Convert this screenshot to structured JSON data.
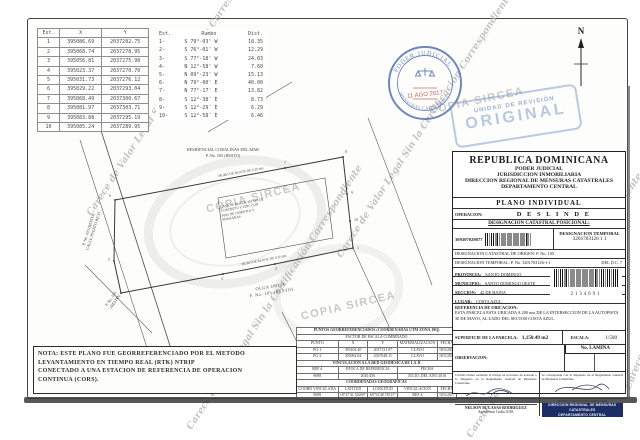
{
  "watermarks": {
    "copia": "COPIA SIRCEA",
    "legal": "Carece de Valor Legal Sin la Certificación Correspondiente"
  },
  "north": {
    "label": "N"
  },
  "stamps": {
    "circular": {
      "top": "PODER JUDICIAL",
      "bottom": "MENSURAS CATASTRALES",
      "date": "11 AGO 2017"
    },
    "revision": {
      "line1": "UNIDAD DE REVISIÓN",
      "line2": "ORIGINAL"
    }
  },
  "tables": {
    "coords": {
      "headers": {
        "est": "Est.",
        "x": "X",
        "y": "Y"
      },
      "rows": [
        {
          "est": "1",
          "x": "395086.69",
          "y": "2037282.75"
        },
        {
          "est": "2",
          "x": "395068.74",
          "y": "2037278.95"
        },
        {
          "est": "3",
          "x": "395056.81",
          "y": "2037275.98"
        },
        {
          "est": "4",
          "x": "395023.37",
          "y": "2037270.70"
        },
        {
          "est": "5",
          "x": "395031.73",
          "y": "2037276.12"
        },
        {
          "est": "6",
          "x": "395029.22",
          "y": "2037293.04"
        },
        {
          "est": "7",
          "x": "395068.49",
          "y": "2037300.67"
        },
        {
          "est": "8",
          "x": "395081.97",
          "y": "2037303.71"
        },
        {
          "est": "9",
          "x": "395083.88",
          "y": "2037295.19"
        },
        {
          "est": "10",
          "x": "395085.24",
          "y": "2037289.95"
        }
      ]
    },
    "bearings": {
      "headers": {
        "est": "Est.",
        "rumbo": "Rumbo",
        "dist": "Dist."
      },
      "rows": [
        {
          "est": "1-",
          "rumbo": "S 79°-03' W",
          "dist": "18.35"
        },
        {
          "est": "2-",
          "rumbo": "S 76°-01' W",
          "dist": "12.29"
        },
        {
          "est": "3-",
          "rumbo": "S 77°-18' W",
          "dist": "24.03"
        },
        {
          "est": "4-",
          "rumbo": "N 12°-58' W",
          "dist": "7.60"
        },
        {
          "est": "5-",
          "rumbo": "N 09°-23' W",
          "dist": "15.13"
        },
        {
          "est": "6-",
          "rumbo": "N 79°-00' E",
          "dist": "40.00"
        },
        {
          "est": "7-",
          "rumbo": "N 77°-17' E",
          "dist": "13.82"
        },
        {
          "est": "8-",
          "rumbo": "S 12°-38' E",
          "dist": "8.73"
        },
        {
          "est": "9-",
          "rumbo": "S 12°-29' E",
          "dist": "6.29"
        },
        {
          "est": "10-",
          "rumbo": "S 12°-58' E",
          "dist": "6.46"
        }
      ]
    },
    "georef": {
      "title": "PUNTOS GEORREFERENCIADOS (COORDENADAS UTM ZONA 19Q)",
      "factor": "FACTOR DE ESCALA COMBINADO",
      "h": {
        "punto": "PUNTO",
        "x": "X",
        "y": "Y",
        "mat": "MATERIALIZACION",
        "fecha": "FECHA"
      },
      "rows": [
        {
          "punto": "PG-1",
          "x": "395104.40",
          "y": "2037131.97",
          "mat": "CLAVO",
          "fecha": "18/5/2017"
        },
        {
          "punto": "PG-2",
          "x": "395092.04",
          "y": "2037048.11",
          "mat": "CLAVO",
          "fecha": "18/5/2017"
        }
      ],
      "vinc_title": "VINCULACION A LA RED GEODESICA DE LA JI",
      "vinc_h": {
        "ref": "REF #",
        "epoca": "EPOCA DE REFERENCIA",
        "fecha": "FECHA"
      },
      "vinc_row": {
        "ref": "9698",
        "epoca": "2010.456",
        "fecha": "JULIO, DEL AÑO 2016"
      },
      "geo_title": "COORDENADAS GEOGRAFICAS",
      "geo_h": {
        "coord": "COORD VINCULADA",
        "lat": "LATITUD",
        "lon": "LONGITUD",
        "vinc": "VINCULACION",
        "fecha": "FECHA"
      },
      "geo_row": {
        "coord": "9698",
        "lat": "18°27'41.50269\"",
        "lon": "69°54'48.78115\"",
        "vinc": "REF #",
        "fecha": "18/5/2017"
      }
    }
  },
  "drawing": {
    "residencial1": "RESIDENCIAL CORALINAS DEL MAR",
    "residencial2": "P. No. 105 (RESTO)",
    "calle1": "CALLE PUERTO RICO",
    "calle2": "P. No. 105 (RESTO)",
    "sw1": "P. No. 105",
    "sw2": "(RESTO)",
    "owner1": "OLGA ORTIZ",
    "owner2": "P. No. 105 (RESTO)",
    "muro": "MURO DE BLOCK DE 0.20 mts",
    "casa1": "CASA DE BLOCK TECHO DE",
    "casa2": "CONCRETO Y ZINC CON",
    "casa3": "PISO DE CEMENTO Y",
    "casa4": "PERSIANAS",
    "vertices": [
      "1",
      "2",
      "3",
      "4",
      "5",
      "6",
      "7",
      "8",
      "9",
      "10"
    ]
  },
  "panel": {
    "country": "REPUBLICA  DOMINICANA",
    "sub1": "PODER  JUDICIAL",
    "sub2": "JURISDICCION INMOBILIARIA",
    "sub3": "DIRECCION REGIONAL DE MENSURAS CATASTRALES",
    "sub4": "DEPARTAMENTO CENTRAL",
    "plan_type": "PLANO INDIVIDUAL",
    "operacion_label": "OPERACION:",
    "operacion_value": "D E S L I N D E",
    "desig_header": "DESIGNACION CATASTRAL POSICIONAL:",
    "barcode1_number": "309307029877",
    "desig_temp_label": "DESIGNACION TEMPORAL",
    "desig_temp_value": "3201703126  1  1",
    "origen": "DESIGNACION CATASTRAL DE ORIGEN: P. No. 105",
    "temporal": "DESIGNACION TEMPORAL: P. No. 3201703126-1-1",
    "dc": "DEL D.C. 7",
    "provincia_label": "PROVINCIA:",
    "provincia": "SANTO DOMINGO",
    "municipio_label": "MUNICIPIO:",
    "municipio": "SANTO DOMINGO OESTE",
    "seccion_label": "SECCION:",
    "seccion": "42 DE HAINA",
    "lugar_label": "LUGAR:",
    "lugar": "COSTA AZUL",
    "barcode2_number": "2134691",
    "ref_label": "REFERENCIA DE UBICACION:",
    "ref_text": "ESTA PARCELA ESTA UBICADA A 200 mts DE LA INTERSECCION DE LA AUTOPISTA 30 DE MAYO, AL LADO DEL SECTOR COSTA AZUL.",
    "superficie_label": "SUPERFICIE DE LA PARCELA:",
    "superficie_value": "1,150.49 m2",
    "escala_label": "ESCALA:",
    "escala_value": "1:500",
    "observacion_label": "OBSERVACION:",
    "lamina_label": "No. LAMINA",
    "cert_left_text": "Certifico haber realizado el trabajo en el terreno de acuerdo a lo dispuesto en el Reglamento General de Mensuras Catastrales.",
    "cert_left_name": "NELSON M. CASAS RODRIGUEZ",
    "cert_left_sub": "Agrimensor Codia. 8181",
    "cert_right_text": "Se corresponde con lo dispuesto en el Reglamento General de Mensuras Catastrales.",
    "stamp1": "FIRMA Y SELLO DEL DIRECTOR",
    "stamp2": "DIRECCION REGIONAL DE MENSURAS CATASTRALES",
    "stamp3": "DEPARTAMENTO CENTRAL"
  },
  "nota": {
    "l1": "NOTA: ESTE PLANO FUE GEORREFERENCIADO POR EL METODO",
    "l2": "LEVANTAMIENTO EN TIEMPO REAL (RTK) NTRIP",
    "l3": "CONECTADO A UNA ESTACION DE REFERENCIA DE OPERACION",
    "l4": "CONTINUA (CORS)."
  }
}
